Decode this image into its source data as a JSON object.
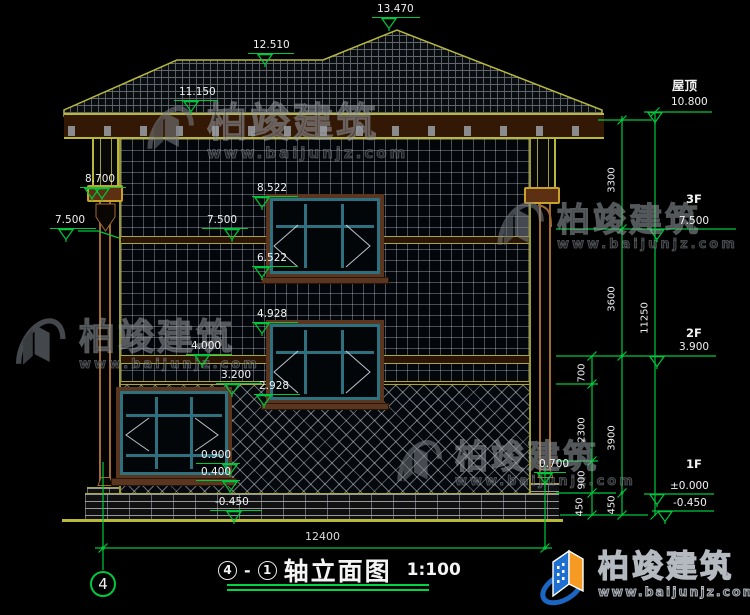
{
  "watermark": {
    "brand": "柏竣建筑",
    "url": "www.baijunjz.com"
  },
  "levels": {
    "peak": "13.470",
    "ridge": "12.510",
    "eave": "11.150",
    "col_cap": "8.700",
    "col_mid": "7.500",
    "w3_top": "8.522",
    "f3_band": "7.500",
    "w3_bot": "6.522",
    "w2_top": "4.928",
    "f2_band": "4.000",
    "belt": "3.200",
    "w2_bot": "2.928",
    "sill_hi": "0.900",
    "sill_lo": "0.400",
    "grade": "-0.450",
    "pipe_foot": "0.700"
  },
  "right": {
    "roof_name": "屋顶",
    "roof_val": "10.800",
    "f3_name": "3F",
    "f3_val": "7.500",
    "f2_name": "2F",
    "f2_val": "3.900",
    "f1_name": "1F",
    "f1_val": "±0.000",
    "grade_val": "-0.450",
    "seg_700": "700",
    "seg_2300": "2300",
    "seg_900": "900",
    "seg_450a": "450",
    "seg_3300": "3300",
    "seg_3600": "3600",
    "seg_3900": "3900",
    "seg_450b": "450",
    "total": "11250"
  },
  "bottom": {
    "width_total": "12400",
    "axis_no": "4"
  },
  "title": {
    "axis_start": "4",
    "separator": "-",
    "axis_end": "1",
    "text": "轴立面图",
    "scale": "1:100"
  },
  "colors": {
    "dim_green": "#00c83c",
    "line_yellow": "#b8b83a",
    "window_teal": "#2f707f",
    "logo_blue": "#1a66c2",
    "logo_orange": "#f59a23"
  }
}
